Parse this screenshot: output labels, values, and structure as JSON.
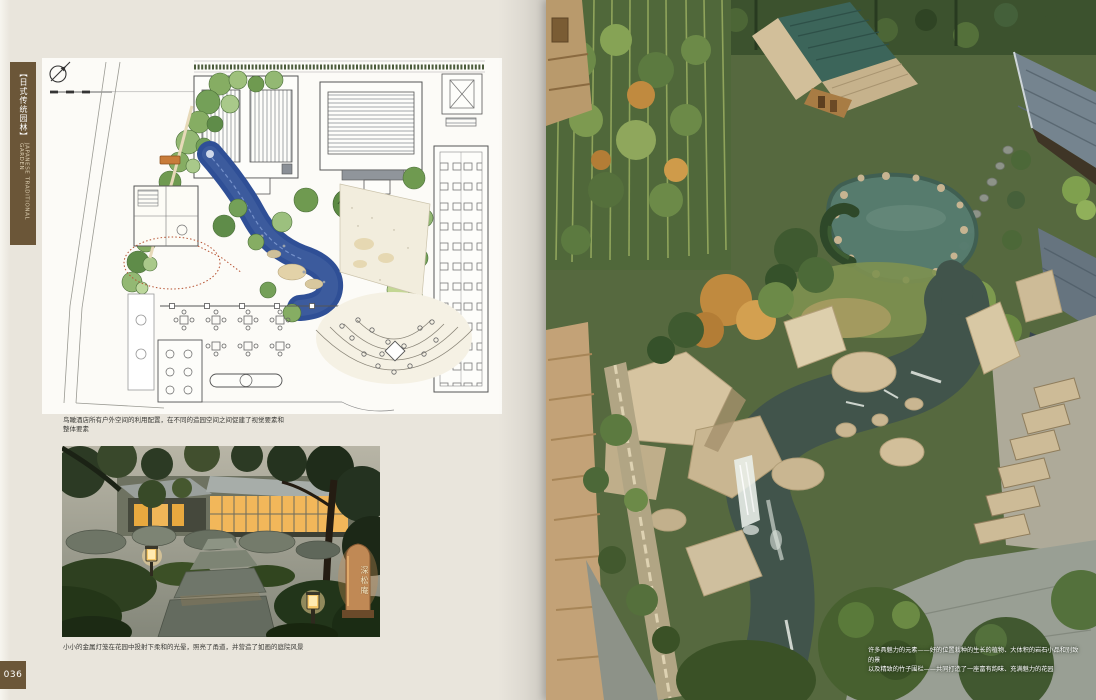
{
  "colors": {
    "page_background": "#e9e5dc",
    "accent_brown": "#6b5638",
    "plan_water_blue": "#2f4f96",
    "aerial_pond_teal": "#577c6f",
    "teahouse_roof_teal": "#3c655a",
    "lantern_glow": "#f2b75a"
  },
  "sidebar": {
    "tab_title_cn": "【日式传统园林】",
    "tab_title_en": "JAPANESE TRADITIONAL GARDEN",
    "page_number": "036"
  },
  "left_page": {
    "plan_caption_line1": "鸟瞰酒店所有户外空间的利用配置，在不同的造园空间之间促建了视觉要素和",
    "plan_caption_line2": "整体要素",
    "photo_caption": "小小的金属灯笼在花园中投射下柔和的光晕，照亮了甬道，并营造了如画的庭院风景",
    "stele_text": "深松庵"
  },
  "right_page": {
    "caption_line1": "许多具魅力的元素——好的位置栽种的生长的植物、大体积的岩石小品和别致的景",
    "caption_line2": "以及精致的竹子围栏——共同打造了一座富有韵味、充满魅力的花园"
  }
}
